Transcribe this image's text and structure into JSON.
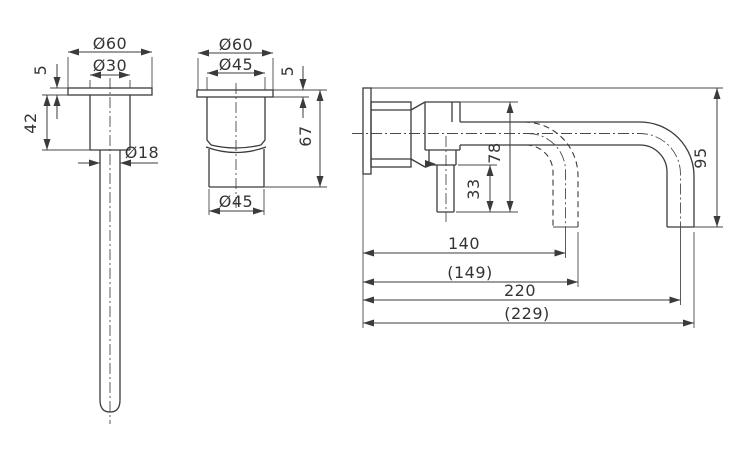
{
  "drawing": {
    "line_color": "#3b3b3b",
    "background": "#ffffff"
  },
  "views": {
    "spout_front": {
      "dims": {
        "flange_diameter": "Ø60",
        "body_diameter": "Ø30",
        "flange_thickness": "5",
        "body_height": "42",
        "tube_diameter": "Ø18"
      }
    },
    "handle_front": {
      "dims": {
        "flange_diameter": "Ø60",
        "body_diameter": "Ø45",
        "flange_thickness": "5",
        "total_height": "67",
        "bottom_diameter": "Ø45"
      }
    },
    "side": {
      "dims": {
        "spout_drop": "78",
        "valve_height": "33",
        "outlet_height": "95",
        "reach_center_short": "140",
        "reach_overall_short": "(149)",
        "reach_center_long": "220",
        "reach_overall_long": "(229)"
      }
    }
  }
}
